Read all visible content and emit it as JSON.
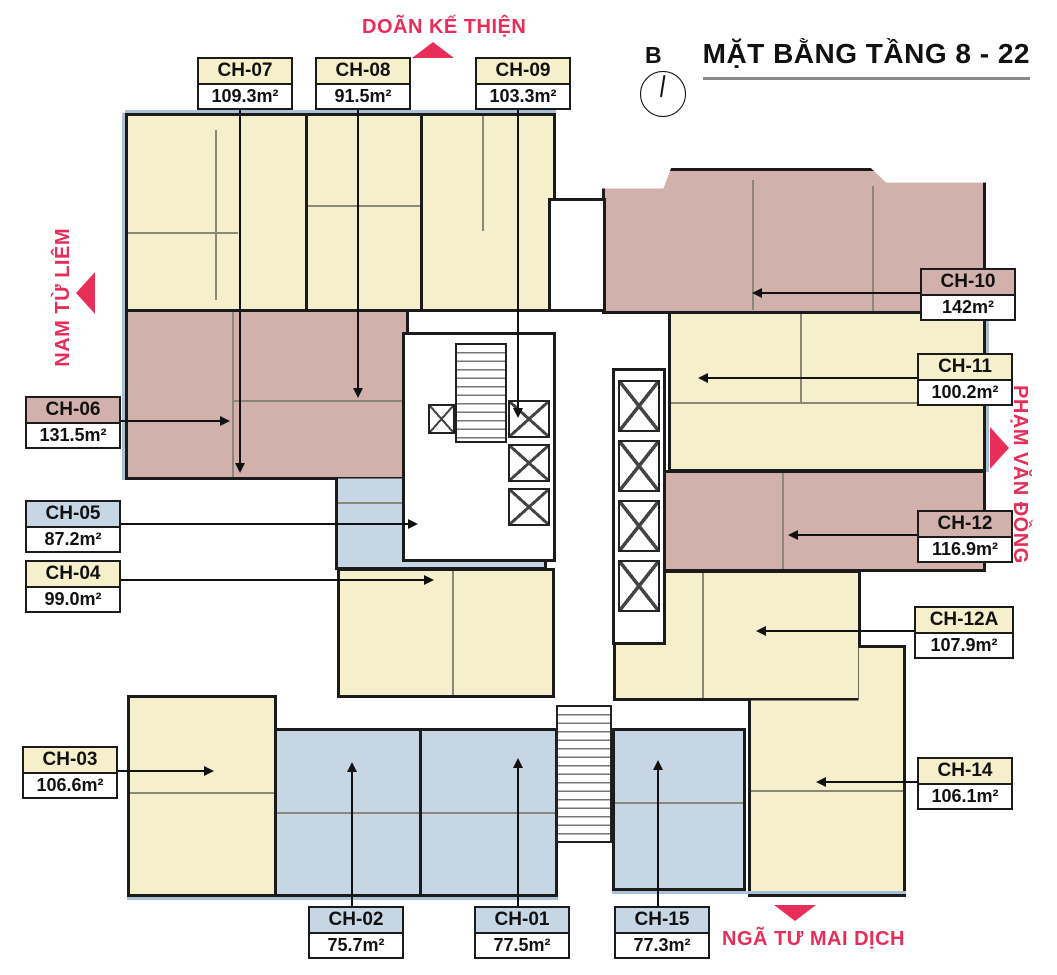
{
  "title": "MẶT BẰNG TẦNG 8 - 22",
  "compass": {
    "label": "B"
  },
  "streets": {
    "top": {
      "label": "DOÃN KẾ THIỆN",
      "arrow": "up"
    },
    "left": {
      "label": "NAM TỪ LIÊM",
      "arrow": "left"
    },
    "right": {
      "label": "PHẠM VĂN ĐỒNG",
      "arrow": "right"
    },
    "bottom": {
      "label": "NGÃ TƯ MAI DỊCH",
      "arrow": "down"
    }
  },
  "colors": {
    "unit_yellow": "#f5efcb",
    "unit_pink": "#d2b1ac",
    "unit_blue": "#c7d6e5",
    "street_accent": "#e62e58",
    "wall": "#1b1b1b"
  },
  "units": [
    {
      "id": "CH-07",
      "area": "109.3m²",
      "type": "yellow"
    },
    {
      "id": "CH-08",
      "area": "91.5m²",
      "type": "yellow"
    },
    {
      "id": "CH-09",
      "area": "103.3m²",
      "type": "yellow"
    },
    {
      "id": "CH-10",
      "area": "142m²",
      "type": "pink"
    },
    {
      "id": "CH-11",
      "area": "100.2m²",
      "type": "yellow"
    },
    {
      "id": "CH-12",
      "area": "116.9m²",
      "type": "pink"
    },
    {
      "id": "CH-12A",
      "area": "107.9m²",
      "type": "yellow"
    },
    {
      "id": "CH-14",
      "area": "106.1m²",
      "type": "yellow"
    },
    {
      "id": "CH-06",
      "area": "131.5m²",
      "type": "pink"
    },
    {
      "id": "CH-05",
      "area": "87.2m²",
      "type": "blue"
    },
    {
      "id": "CH-04",
      "area": "99.0m²",
      "type": "yellow"
    },
    {
      "id": "CH-03",
      "area": "106.6m²",
      "type": "yellow"
    },
    {
      "id": "CH-02",
      "area": "75.7m²",
      "type": "blue"
    },
    {
      "id": "CH-01",
      "area": "77.5m²",
      "type": "blue"
    },
    {
      "id": "CH-15",
      "area": "77.3m²",
      "type": "blue"
    }
  ]
}
